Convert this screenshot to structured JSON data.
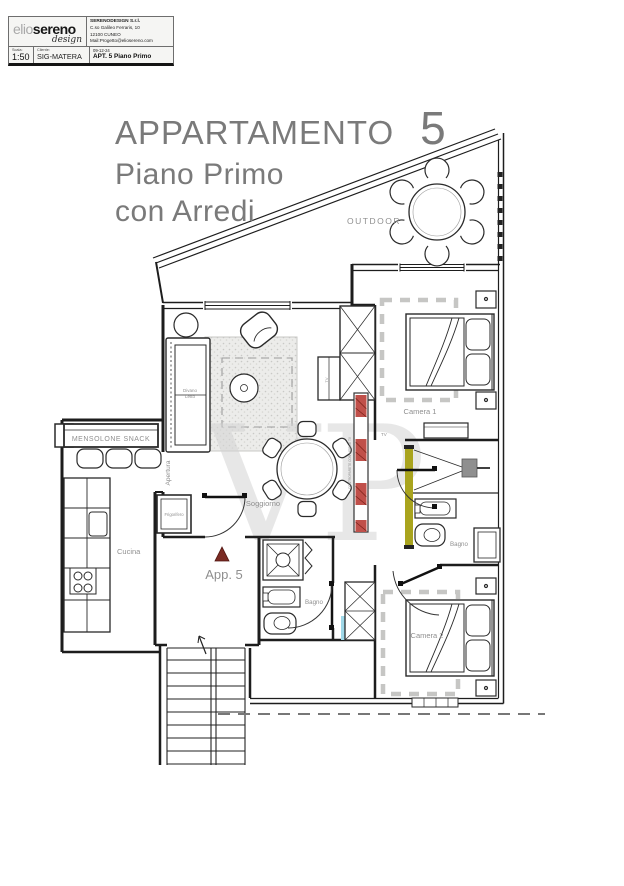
{
  "title_block": {
    "logo_first": "elio",
    "logo_second": "sereno",
    "logo_script": "design",
    "company_name": "SERENODESIGN S.r.l.",
    "company_address": "C.so Galileo Ferraris, 10",
    "company_city": "12100 CUNEO",
    "company_mail": "Mail:Progetto@eliosereno.com",
    "scala_label": "Scala:",
    "scala_value": "1:50",
    "cliente_label": "Cliente:",
    "cliente_value": "SIG-MATERA",
    "date": "09-12-24",
    "project": "APT. 5 Piano Primo"
  },
  "heading": {
    "title": "APPARTAMENTO",
    "number": "5",
    "line2": "Piano Primo",
    "line3": "con Arredi"
  },
  "labels": {
    "outdoor": "OUTDOOR",
    "soggiorno": "Soggiorno",
    "camera1": "Camera 1",
    "camera2": "Camera 2",
    "bagno1": "Bagno",
    "bagno2": "Bagno",
    "cucina": "Cucina",
    "mensolone": "MENSOLONE SNACK",
    "apertura": "Apertura",
    "frigorifero": "Frigorifero",
    "divano_line1": "Divano",
    "divano_line2": "Letto",
    "app5": "App. 5",
    "tv_cabinet": "TV",
    "tv_corridor": "TV",
    "wall_note": "CONTROPARETE CON MOBILE TV"
  },
  "watermark": "VP",
  "colors": {
    "hatch_red": "#c0504a",
    "wall_olive": "#a9a41e",
    "marker_maroon": "#7a2b23",
    "accent_cyan": "#9fd8e8",
    "label_gray": "#8f8f8f",
    "heading_gray": "#7a7a7a"
  }
}
